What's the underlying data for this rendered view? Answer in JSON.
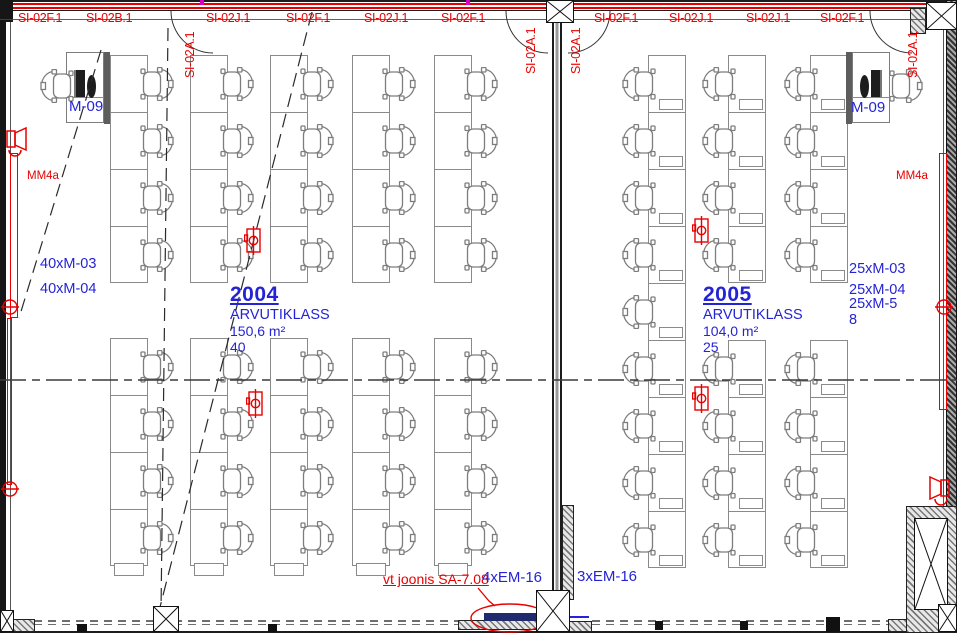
{
  "colors": {
    "red": "#e80000",
    "blue": "#2424d6",
    "navy": "#202a6e",
    "wall": "#1c1c1c",
    "furniture_line": "#8a8a8a"
  },
  "top_axis_labels": [
    {
      "text": "SI-02F.1",
      "x": 18
    },
    {
      "text": "SI-02B.1",
      "x": 86
    },
    {
      "text": "SI-02J.1",
      "x": 206
    },
    {
      "text": "SI-02F.1",
      "x": 286
    },
    {
      "text": "SI-02J.1",
      "x": 364
    },
    {
      "text": "SI-02F.1",
      "x": 441
    },
    {
      "text": "SI-02F.1",
      "x": 594
    },
    {
      "text": "SI-02J.1",
      "x": 669
    },
    {
      "text": "SI-02J.1",
      "x": 746
    },
    {
      "text": "SI-02F.1",
      "x": 820
    }
  ],
  "vertical_axis_labels": [
    {
      "text": "SI-02A.1",
      "x": 183,
      "y": 16
    },
    {
      "text": "SI-02A.1",
      "x": 524,
      "y": 12
    },
    {
      "text": "SI-02A.1",
      "x": 569,
      "y": 12
    },
    {
      "text": "SI-02A.1",
      "x": 906,
      "y": 16
    }
  ],
  "rooms": [
    {
      "number": "2004",
      "name": "ARVUTIKLASS",
      "area": "150,6 m²",
      "seats": "40",
      "teacher_station": "M-09",
      "wall_device": "MM4a",
      "equipment_labels": [
        "40xM-03",
        "40xM-04"
      ]
    },
    {
      "number": "2005",
      "name": "ARVUTIKLASS",
      "area": "104,0 m²",
      "seats": "25",
      "teacher_station": "M-09",
      "wall_device": "MM4a",
      "equipment_labels": [
        "25xM-03",
        "25xM-04",
        "25xM-5",
        "8"
      ]
    }
  ],
  "bottom_labels": {
    "reference_note": "vt joonis SA-7.08",
    "em_left": "4xEM-16",
    "em_right": "3xEM-16"
  },
  "furniture": {
    "cell_height": 57,
    "desk_width": 38,
    "strips": [
      {
        "x": 110,
        "y": 55,
        "rows": 4,
        "side": "right",
        "monitor": false,
        "endcap": false
      },
      {
        "x": 190,
        "y": 55,
        "rows": 4,
        "side": "right",
        "monitor": false,
        "endcap": false
      },
      {
        "x": 270,
        "y": 55,
        "rows": 4,
        "side": "right",
        "monitor": false,
        "endcap": false
      },
      {
        "x": 352,
        "y": 55,
        "rows": 4,
        "side": "right",
        "monitor": false,
        "endcap": false
      },
      {
        "x": 434,
        "y": 55,
        "rows": 4,
        "side": "right",
        "monitor": false,
        "endcap": false
      },
      {
        "x": 110,
        "y": 338,
        "rows": 4,
        "side": "right",
        "monitor": false,
        "endcap": true
      },
      {
        "x": 190,
        "y": 338,
        "rows": 4,
        "side": "right",
        "monitor": false,
        "endcap": true
      },
      {
        "x": 270,
        "y": 338,
        "rows": 4,
        "side": "right",
        "monitor": false,
        "endcap": true
      },
      {
        "x": 352,
        "y": 338,
        "rows": 4,
        "side": "right",
        "monitor": false,
        "endcap": true
      },
      {
        "x": 434,
        "y": 338,
        "rows": 4,
        "side": "right",
        "monitor": false,
        "endcap": true
      },
      {
        "x": 648,
        "y": 55,
        "rows": 9,
        "side": "left",
        "monitor": true,
        "endcap": false
      },
      {
        "x": 728,
        "y": 55,
        "rows": 4,
        "side": "left",
        "monitor": true,
        "endcap": false
      },
      {
        "x": 728,
        "y": 340,
        "rows": 4,
        "side": "left",
        "monitor": true,
        "endcap": false
      },
      {
        "x": 810,
        "y": 55,
        "rows": 4,
        "side": "left",
        "monitor": true,
        "endcap": false
      },
      {
        "x": 810,
        "y": 340,
        "rows": 4,
        "side": "left",
        "monitor": true,
        "endcap": false
      }
    ],
    "floor_sockets": [
      {
        "x": 244,
        "y": 226
      },
      {
        "x": 246,
        "y": 389
      },
      {
        "x": 692,
        "y": 216
      },
      {
        "x": 692,
        "y": 384
      }
    ]
  }
}
